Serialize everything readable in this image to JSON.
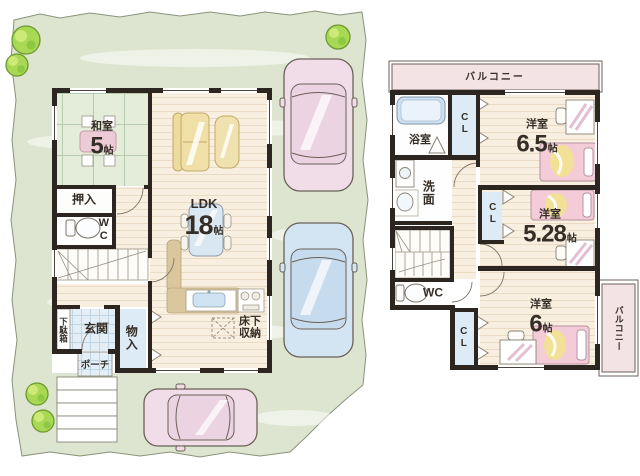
{
  "floor1": {
    "washitsu_name": "和室",
    "washitsu_size": "5",
    "washitsu_unit": "帖",
    "oshiire": "押入",
    "wc": "WC",
    "genkan": "玄関",
    "getabako": "下駄箱",
    "monoire": "物入",
    "porch": "ポーチ",
    "ldk_name": "LDK",
    "ldk_size": "18",
    "ldk_unit": "帖",
    "yukashita_line1": "床下",
    "yukashita_line2": "収納"
  },
  "floor2": {
    "balcony_top": "バルコニー",
    "balcony_right": "バルコニー",
    "bath": "浴室",
    "senmen": "洗面",
    "wc": "WC",
    "cl1": "CL",
    "cl2": "CL",
    "cl3": "CL",
    "room65_name": "洋室",
    "room65_size": "6.5",
    "room65_unit": "帖",
    "room528_name": "洋室",
    "room528_size": "5.28",
    "room528_unit": "帖",
    "room6_name": "洋室",
    "room6_size": "6",
    "room6_unit": "帖"
  },
  "colors": {
    "site_green": "#dde5d0",
    "wall": "#2d2520",
    "tatami_green": "#e4edda",
    "wood_floor": "#f8efe1",
    "closet_blue": "#dcebf6",
    "balcony_pink": "#f4e3e5",
    "car_pink": "#f1dde8",
    "car_blue": "#d3e4f2",
    "bed_pink": "#f3ccd8",
    "blanket_yellow": "#f2e096",
    "tree_green": "#a9d855"
  }
}
